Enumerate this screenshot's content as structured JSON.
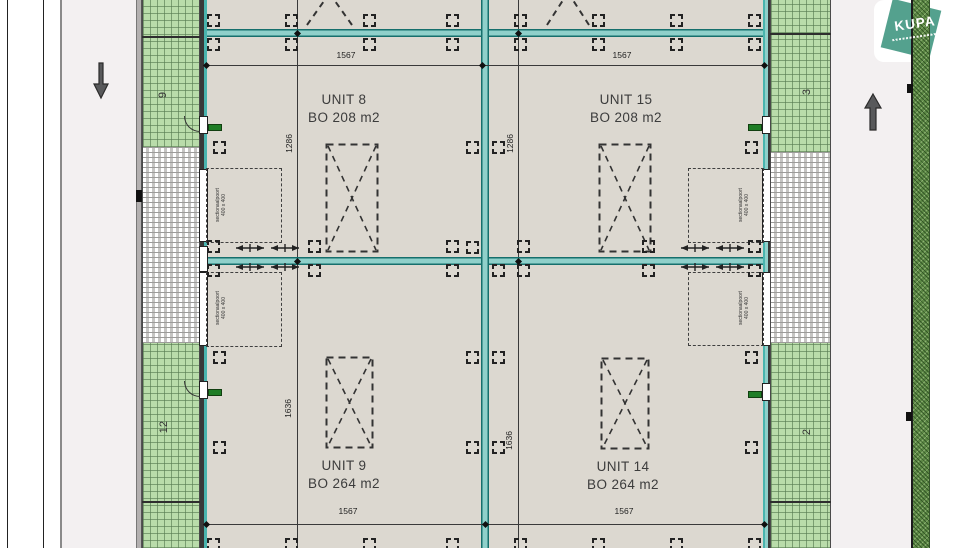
{
  "logo": {
    "text": "KUPA"
  },
  "units": {
    "u8": {
      "name": "UNIT 8",
      "area": "BO 208 m2"
    },
    "u15": {
      "name": "UNIT 15",
      "area": "BO 208 m2"
    },
    "u9": {
      "name": "UNIT 9",
      "area": "BO 264 m2"
    },
    "u14": {
      "name": "UNIT 14",
      "area": "BO 264 m2"
    }
  },
  "dimensions": {
    "unit_width": "1567",
    "upper_unit_depth": "1286",
    "lower_unit_depth": "1636"
  },
  "lot_numbers": {
    "left_top": "9",
    "left_bottom": "12",
    "right_top": "3",
    "right_bottom": "2"
  },
  "sectional_door": {
    "line1": "sectionaalpoort",
    "line2": "400 x 400"
  },
  "icons": {
    "arrow_down": "direction-arrow-down",
    "arrow_up": "direction-arrow-up"
  },
  "colors": {
    "wall_accent": "#2a8f8a",
    "grass": "#b9dcaa",
    "hedge": "#5d8946",
    "paving": "#dedddb",
    "floor": "#dcd8d0",
    "road": "#f3f0f1",
    "logo_teal": "#54a18e",
    "door_green": "#1f7d26"
  }
}
